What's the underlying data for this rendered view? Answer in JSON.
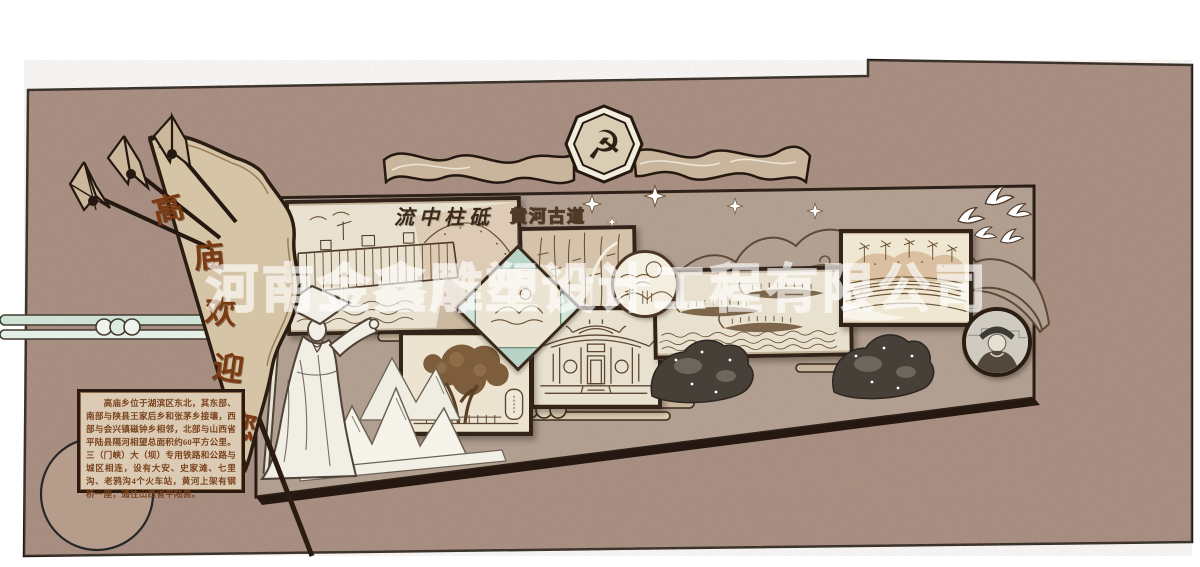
{
  "watermark": {
    "text": "河南金鑫雕塑设计工程有限公司"
  },
  "emblem": {
    "symbol": "☭"
  },
  "flag": {
    "text": "高庙欢迎您",
    "chars": [
      "高",
      "庙",
      "欢",
      "迎",
      "您"
    ]
  },
  "labels": {
    "dam_calligraphy": "流中柱砥",
    "gorge_title": "黄河古道"
  },
  "intro_panel": {
    "text": "　　高庙乡位于湖滨区东北，其东部、南部与陕县王家后乡和张茅乡接壤，西部与会兴镇磁钟乡相邻，北部与山西省平陆县隔河相望总面积约60平方公里。三（门峡）大（坝）专用铁路和公路与城区相连，设有大安、史家滩、七里沟、老鸦沟4个火车站，黄河上架有钢桥一座，通往山西省平陆县。"
  },
  "colors": {
    "outer_wall": "#a2877a",
    "inner_wall": "#b2a092",
    "frame_dark": "#33241a",
    "flag_tan": "#d6c4a6",
    "text_brown": "#7a421c",
    "teal_scroll": "#cfe2d6",
    "art_paper": "#e9e1cf"
  }
}
